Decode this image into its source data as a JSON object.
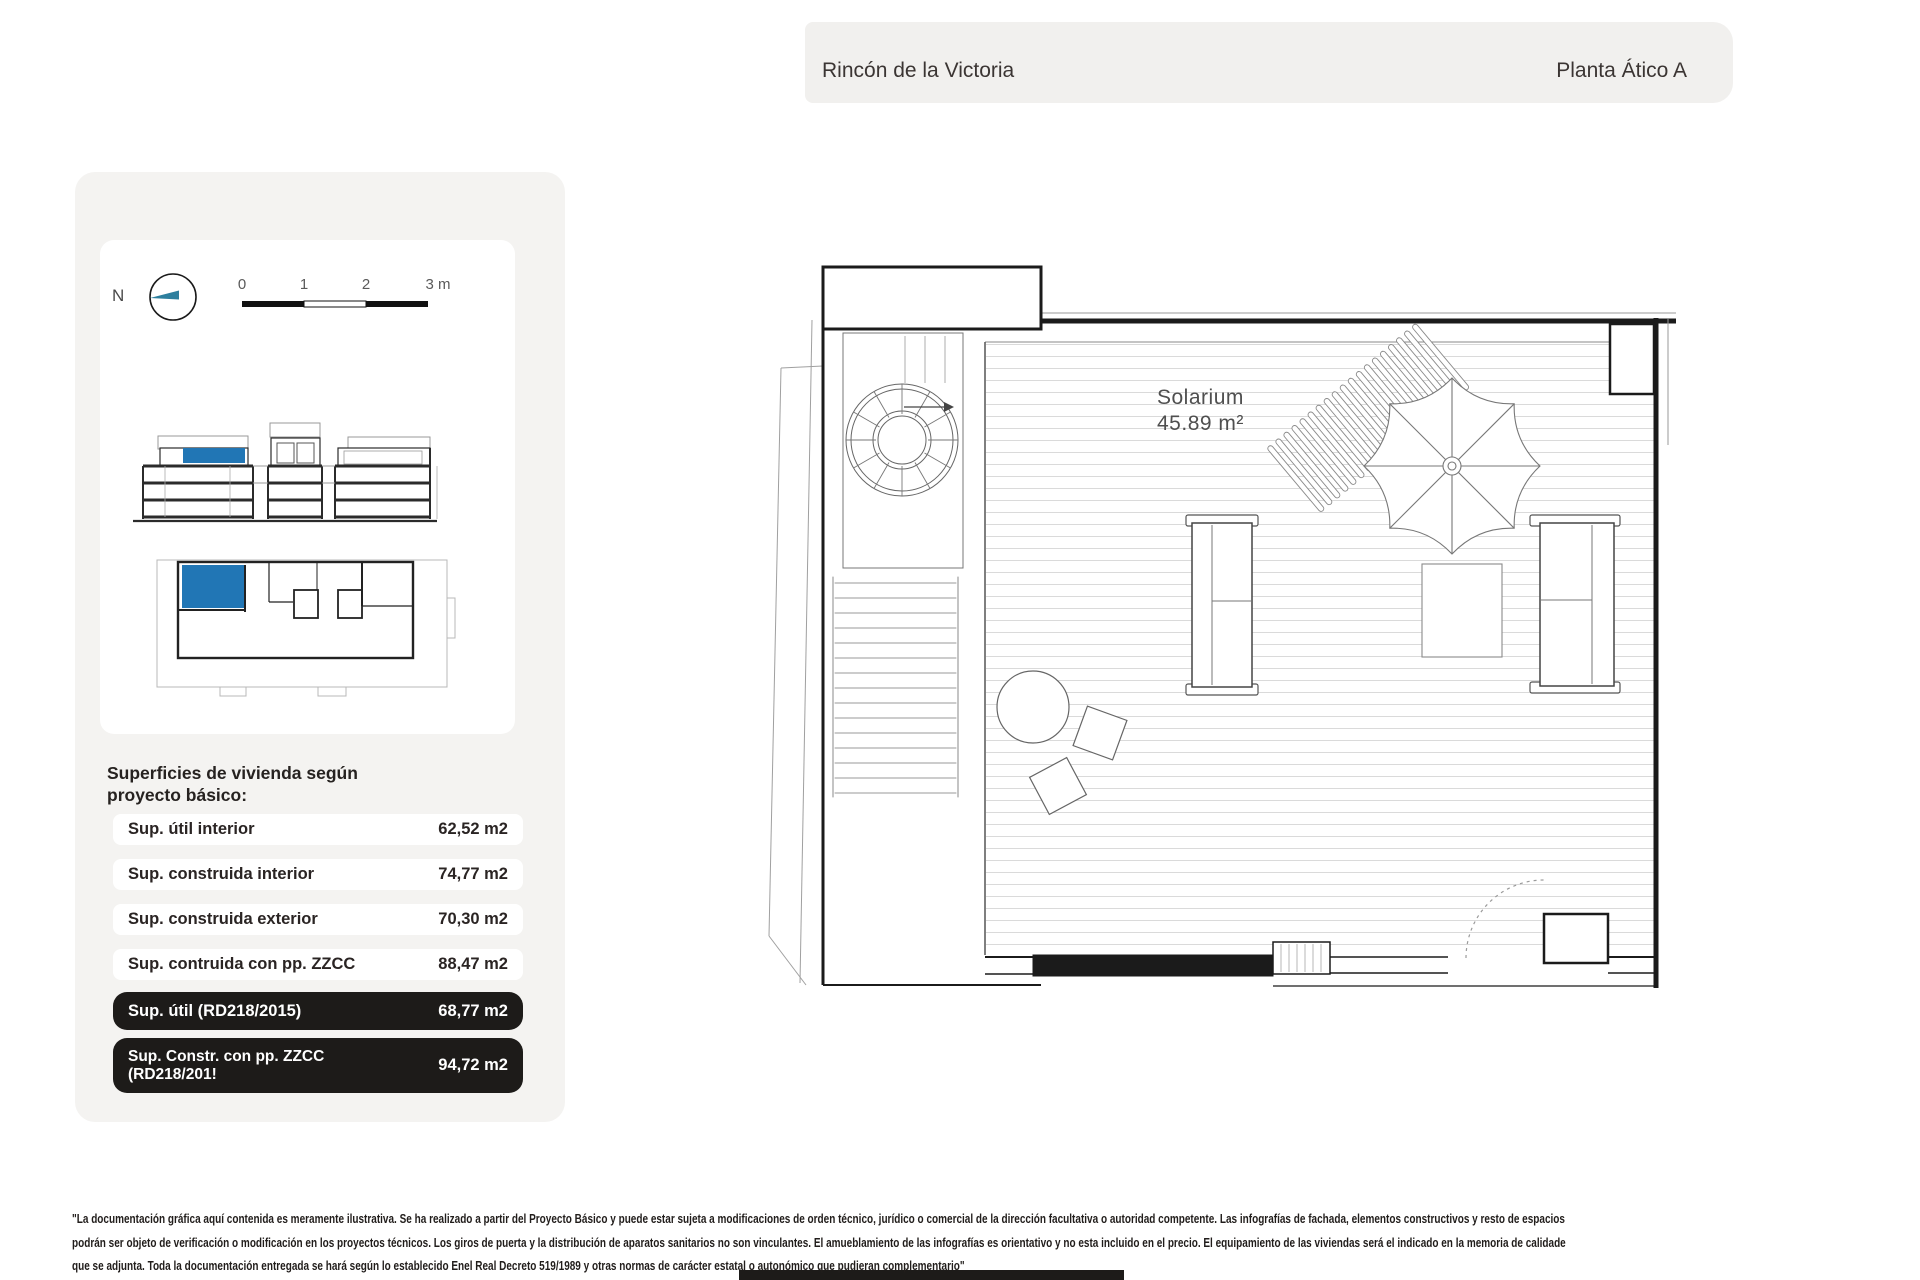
{
  "header": {
    "project_name": "Rincón de la Victoria",
    "plan_name": "Planta Ático A"
  },
  "legend": {
    "compass_label": "N",
    "scale_ticks": [
      "0",
      "1",
      "2",
      "3 m"
    ]
  },
  "areas_panel": {
    "heading_lines": [
      "Superficies de vivienda según",
      "proyecto básico:"
    ],
    "rows": [
      {
        "label": "Sup. útil interior",
        "value": "62,52 m2",
        "style": "light"
      },
      {
        "label": "Sup. construida interior",
        "value": "74,77 m2",
        "style": "light"
      },
      {
        "label": "Sup. construida exterior",
        "value": "70,30 m2",
        "style": "light"
      },
      {
        "label": "Sup. contruida con pp. ZZCC",
        "value": "88,47 m2",
        "style": "light"
      },
      {
        "label": "Sup. útil (RD218/2015)",
        "value": "68,77 m2",
        "style": "dark"
      },
      {
        "label": "Sup. Constr. con pp. ZZCC",
        "label_line2": "(RD218/201!",
        "value": "94,72 m2",
        "style": "dark"
      }
    ]
  },
  "floor_plan": {
    "room_label": "Solarium",
    "room_area": "45.89 m²"
  },
  "disclaimer_lines": [
    "\"La documentación gráfica aquí contenida es meramente ilustrativa. Se ha realizado a partir del Proyecto Básico y puede estar sujeta a modificaciones de orden técnico, jurídico o comercial de la dirección facultativa o autoridad competente. Las infografías de fachada, elementos constructivos y resto de espacios",
    "podrán ser objeto de verificación o modificación en los proyectos técnicos. Los giros de puerta y la distribución de aparatos sanitarios no son vinculantes. El amueblamiento de las infografías es orientativo y no esta incluido en el precio. El equipamiento de las viviendas será el indicado en la memoria de calidade",
    "que se adjunta. Toda la documentación entregada se hará según lo establecido Enel Real Decreto 519/1989 y otras normas de carácter estatal o autonómico que pudieran complementario\""
  ],
  "colors": {
    "highlight_blue": "#2176b5",
    "compass_teal": "#2d7f9e",
    "dark_row_bg": "#1d1b19",
    "header_bg": "#f1f0ee",
    "card_bg": "#f4f3f1"
  }
}
